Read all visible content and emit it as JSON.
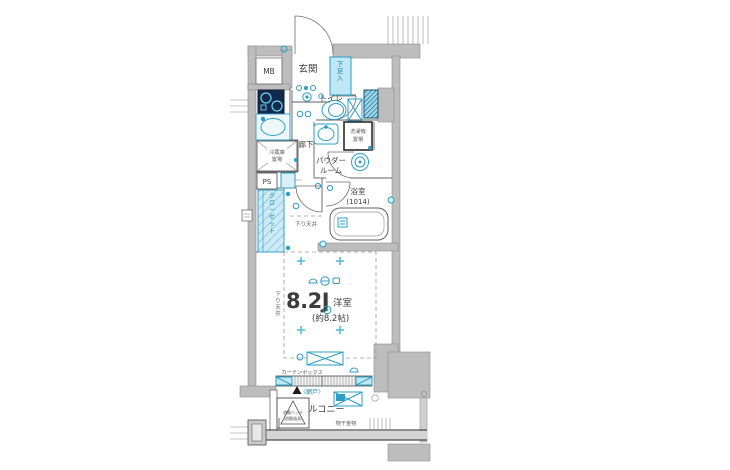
{
  "meta": {
    "type": "floor-plan",
    "description": "Japanese one-room apartment floor plan (1K layout)"
  },
  "colors": {
    "wall_gray": "#bdbdbd",
    "accent_cyan": "#2e9dc4",
    "accent_fill": "#d9f0f8",
    "text_dark": "#3c3c3c"
  },
  "floorplan": {
    "labels": {
      "mb": "MB",
      "genkan": "玄関",
      "shoe_box": "下足入",
      "toilet": "トイレ",
      "hallway": "廊下",
      "powder_line1": "パウダー",
      "powder_line2": "ルーム",
      "washer_line1": "洗濯機",
      "washer_line2": "置場",
      "fridge_line1": "冷蔵庫",
      "fridge_line2": "置場",
      "ps": "PS",
      "closet": "クローゼット",
      "bath": "浴室",
      "bath_size": "(1014)",
      "down_ceiling_mid": "下り天井",
      "down_ceiling_left": "下り天井",
      "room_size": "8.2J",
      "room_name": "洋室",
      "room_size_note": "(約8.2帖)",
      "curtain_box": "カーテンボックス",
      "screen_door": "〈網戸〉",
      "balcony": "バルコニー",
      "hatch_line1": "避難ハッチ",
      "hatch_line2": "(避難器具)",
      "laundry_hw": "物干金物"
    }
  }
}
